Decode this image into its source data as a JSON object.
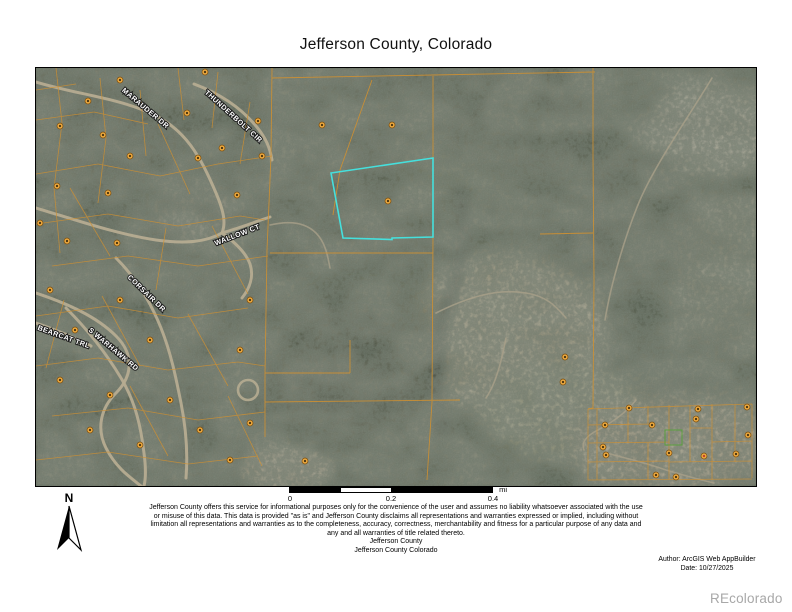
{
  "page": {
    "title": "Jefferson County, Colorado",
    "watermark": "REcolorado"
  },
  "north_arrow": {
    "label": "N"
  },
  "scale_bar": {
    "ticks": [
      "0",
      "0.2",
      "0.4"
    ],
    "unit": "mi"
  },
  "footer": {
    "disclaimer_lines": [
      "Jefferson County offers this service for informational purposes only for the convenience of the user and assumes no liability whatsoever associated with the use",
      "or misuse of this data. This data is provided \"as is\" and Jefferson County disclaims all representations and warranties expressed or implied, including without",
      "limitation all representations and warranties as to the completeness, accuracy, correctness, merchantability and fitness for a particular purpose of any data and",
      "any and all warranties of title related thereto."
    ],
    "agency": "Jefferson County",
    "agency_sub": "Jefferson County Colorado",
    "author": "Author: ArcGIS Web AppBuilder",
    "date": "Date: 10/27/2025"
  },
  "map": {
    "road_labels": [
      {
        "text": "MARAUDER DR",
        "x": 108,
        "y": 42,
        "rotate": 40
      },
      {
        "text": "THUNDERBOLT CIR",
        "x": 196,
        "y": 50,
        "rotate": 42
      },
      {
        "text": "WALLOW CT",
        "x": 202,
        "y": 169,
        "rotate": -21
      },
      {
        "text": "CORSAIR DR",
        "x": 109,
        "y": 227,
        "rotate": 44
      },
      {
        "text": "BEARCAT TRL",
        "x": 27,
        "y": 271,
        "rotate": 20
      },
      {
        "text": "S WARHAWK RD",
        "x": 76,
        "y": 283,
        "rotate": 40
      }
    ],
    "selected_parcel": {
      "points": "295,105 397,90 397,169 356,170 356,171.5 307,170",
      "color": "#45e0dd"
    },
    "parcel_line_color": "#cf9031",
    "green_parcel": {
      "x": 629,
      "y": 362,
      "w": 17,
      "h": 15,
      "color": "#5aa03e"
    },
    "special_dot": {
      "x": 668,
      "y": 388,
      "color": "#c03a2b"
    },
    "address_dots": [
      [
        52,
        33
      ],
      [
        151,
        45
      ],
      [
        24,
        58
      ],
      [
        67,
        67
      ],
      [
        94,
        88
      ],
      [
        162,
        90
      ],
      [
        186,
        80
      ],
      [
        222,
        53
      ],
      [
        21,
        118
      ],
      [
        72,
        125
      ],
      [
        4,
        155
      ],
      [
        31,
        173
      ],
      [
        81,
        175
      ],
      [
        201,
        127
      ],
      [
        226,
        88
      ],
      [
        169,
        4
      ],
      [
        84,
        12
      ],
      [
        14,
        222
      ],
      [
        84,
        232
      ],
      [
        39,
        262
      ],
      [
        114,
        272
      ],
      [
        24,
        312
      ],
      [
        74,
        327
      ],
      [
        134,
        332
      ],
      [
        54,
        362
      ],
      [
        104,
        377
      ],
      [
        164,
        362
      ],
      [
        194,
        392
      ],
      [
        214,
        232
      ],
      [
        204,
        282
      ],
      [
        214,
        355
      ],
      [
        269,
        393
      ],
      [
        286,
        57
      ],
      [
        356,
        57
      ],
      [
        352,
        133
      ],
      [
        529,
        289
      ],
      [
        527,
        314
      ],
      [
        593,
        340
      ],
      [
        662,
        341
      ],
      [
        569,
        357
      ],
      [
        616,
        357
      ],
      [
        660,
        351
      ],
      [
        711,
        339
      ],
      [
        567,
        379
      ],
      [
        633,
        385
      ],
      [
        700,
        386
      ],
      [
        570,
        387
      ],
      [
        620,
        407
      ],
      [
        640,
        409
      ],
      [
        712,
        367
      ]
    ]
  }
}
